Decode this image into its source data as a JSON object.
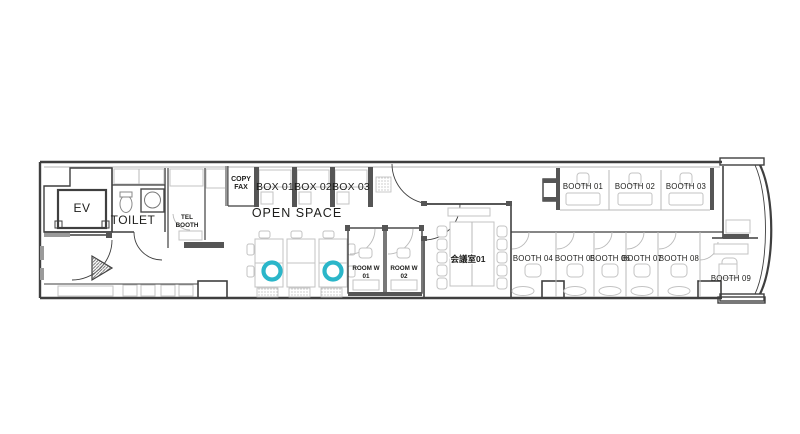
{
  "colors": {
    "highlight": "#2bb6c9",
    "wall": "#3f3f3f",
    "furniture": "#c3c3c3",
    "text": "#1d1d1b"
  },
  "rooms": {
    "ev": {
      "label": "EV"
    },
    "toilet": {
      "label": "TOILET"
    },
    "tel_booth": {
      "line1": "TEL",
      "line2": "BOOTH"
    },
    "copy_fax": {
      "line1": "COPY",
      "line2": "FAX"
    },
    "box01": {
      "label": "BOX 01"
    },
    "box02": {
      "label": "BOX 02"
    },
    "box03": {
      "label": "BOX 03"
    },
    "open_space": {
      "label": "OPEN SPACE"
    },
    "room_w01": {
      "line1": "ROOM W",
      "line2": "01"
    },
    "room_w02": {
      "line1": "ROOM W",
      "line2": "02"
    },
    "meeting_room01": {
      "label": "会議室01"
    },
    "booth01": {
      "label": "BOOTH 01"
    },
    "booth02": {
      "label": "BOOTH 02"
    },
    "booth03": {
      "label": "BOOTH 03"
    },
    "booth04": {
      "label": "BOOTH 04"
    },
    "booth05": {
      "label": "BOOTH 05"
    },
    "booth06": {
      "label": "BOOTH 06"
    },
    "booth07": {
      "label": "BOOTH 07"
    },
    "booth08": {
      "label": "BOOTH 08"
    },
    "booth09": {
      "label": "BOOTH 09"
    }
  }
}
